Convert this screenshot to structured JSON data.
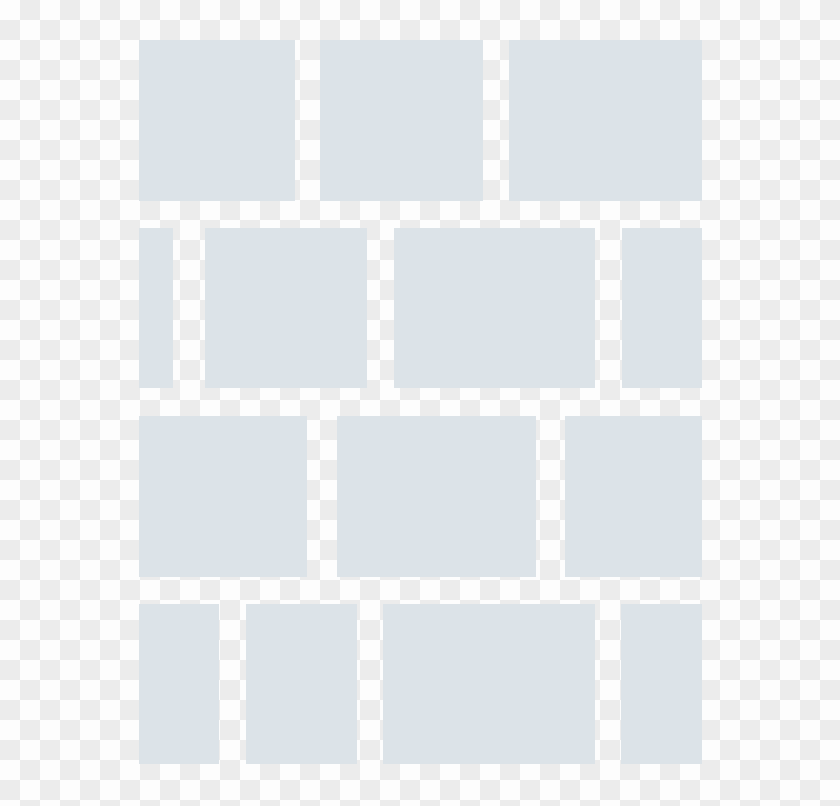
{
  "canvas": {
    "width": 840,
    "height": 806
  },
  "background": {
    "type": "transparency-checkerboard",
    "square_size": 20,
    "color_light": "#fdfdfd",
    "color_dark": "#ececec"
  },
  "icon": {
    "name": "brick-wall",
    "brick_color": "#dce3e8",
    "bounds": {
      "left": 139,
      "top": 40,
      "right": 702,
      "bottom": 764
    },
    "rows": [
      {
        "top": 40,
        "height": 161,
        "bricks": [
          {
            "left": 139,
            "width": 156
          },
          {
            "left": 320,
            "width": 163
          },
          {
            "left": 509,
            "width": 193
          }
        ]
      },
      {
        "top": 228,
        "height": 160,
        "bricks": [
          {
            "left": 139,
            "width": 34
          },
          {
            "left": 205,
            "width": 162
          },
          {
            "left": 394,
            "width": 201
          },
          {
            "left": 622,
            "width": 80
          }
        ]
      },
      {
        "top": 416,
        "height": 161,
        "bricks": [
          {
            "left": 139,
            "width": 168
          },
          {
            "left": 337,
            "width": 199
          },
          {
            "left": 565,
            "width": 137
          }
        ]
      },
      {
        "top": 604,
        "height": 160,
        "bricks": [
          {
            "left": 139,
            "width": 80
          },
          {
            "left": 246,
            "width": 111
          },
          {
            "left": 383,
            "width": 212
          },
          {
            "left": 621,
            "width": 81
          }
        ]
      }
    ]
  }
}
